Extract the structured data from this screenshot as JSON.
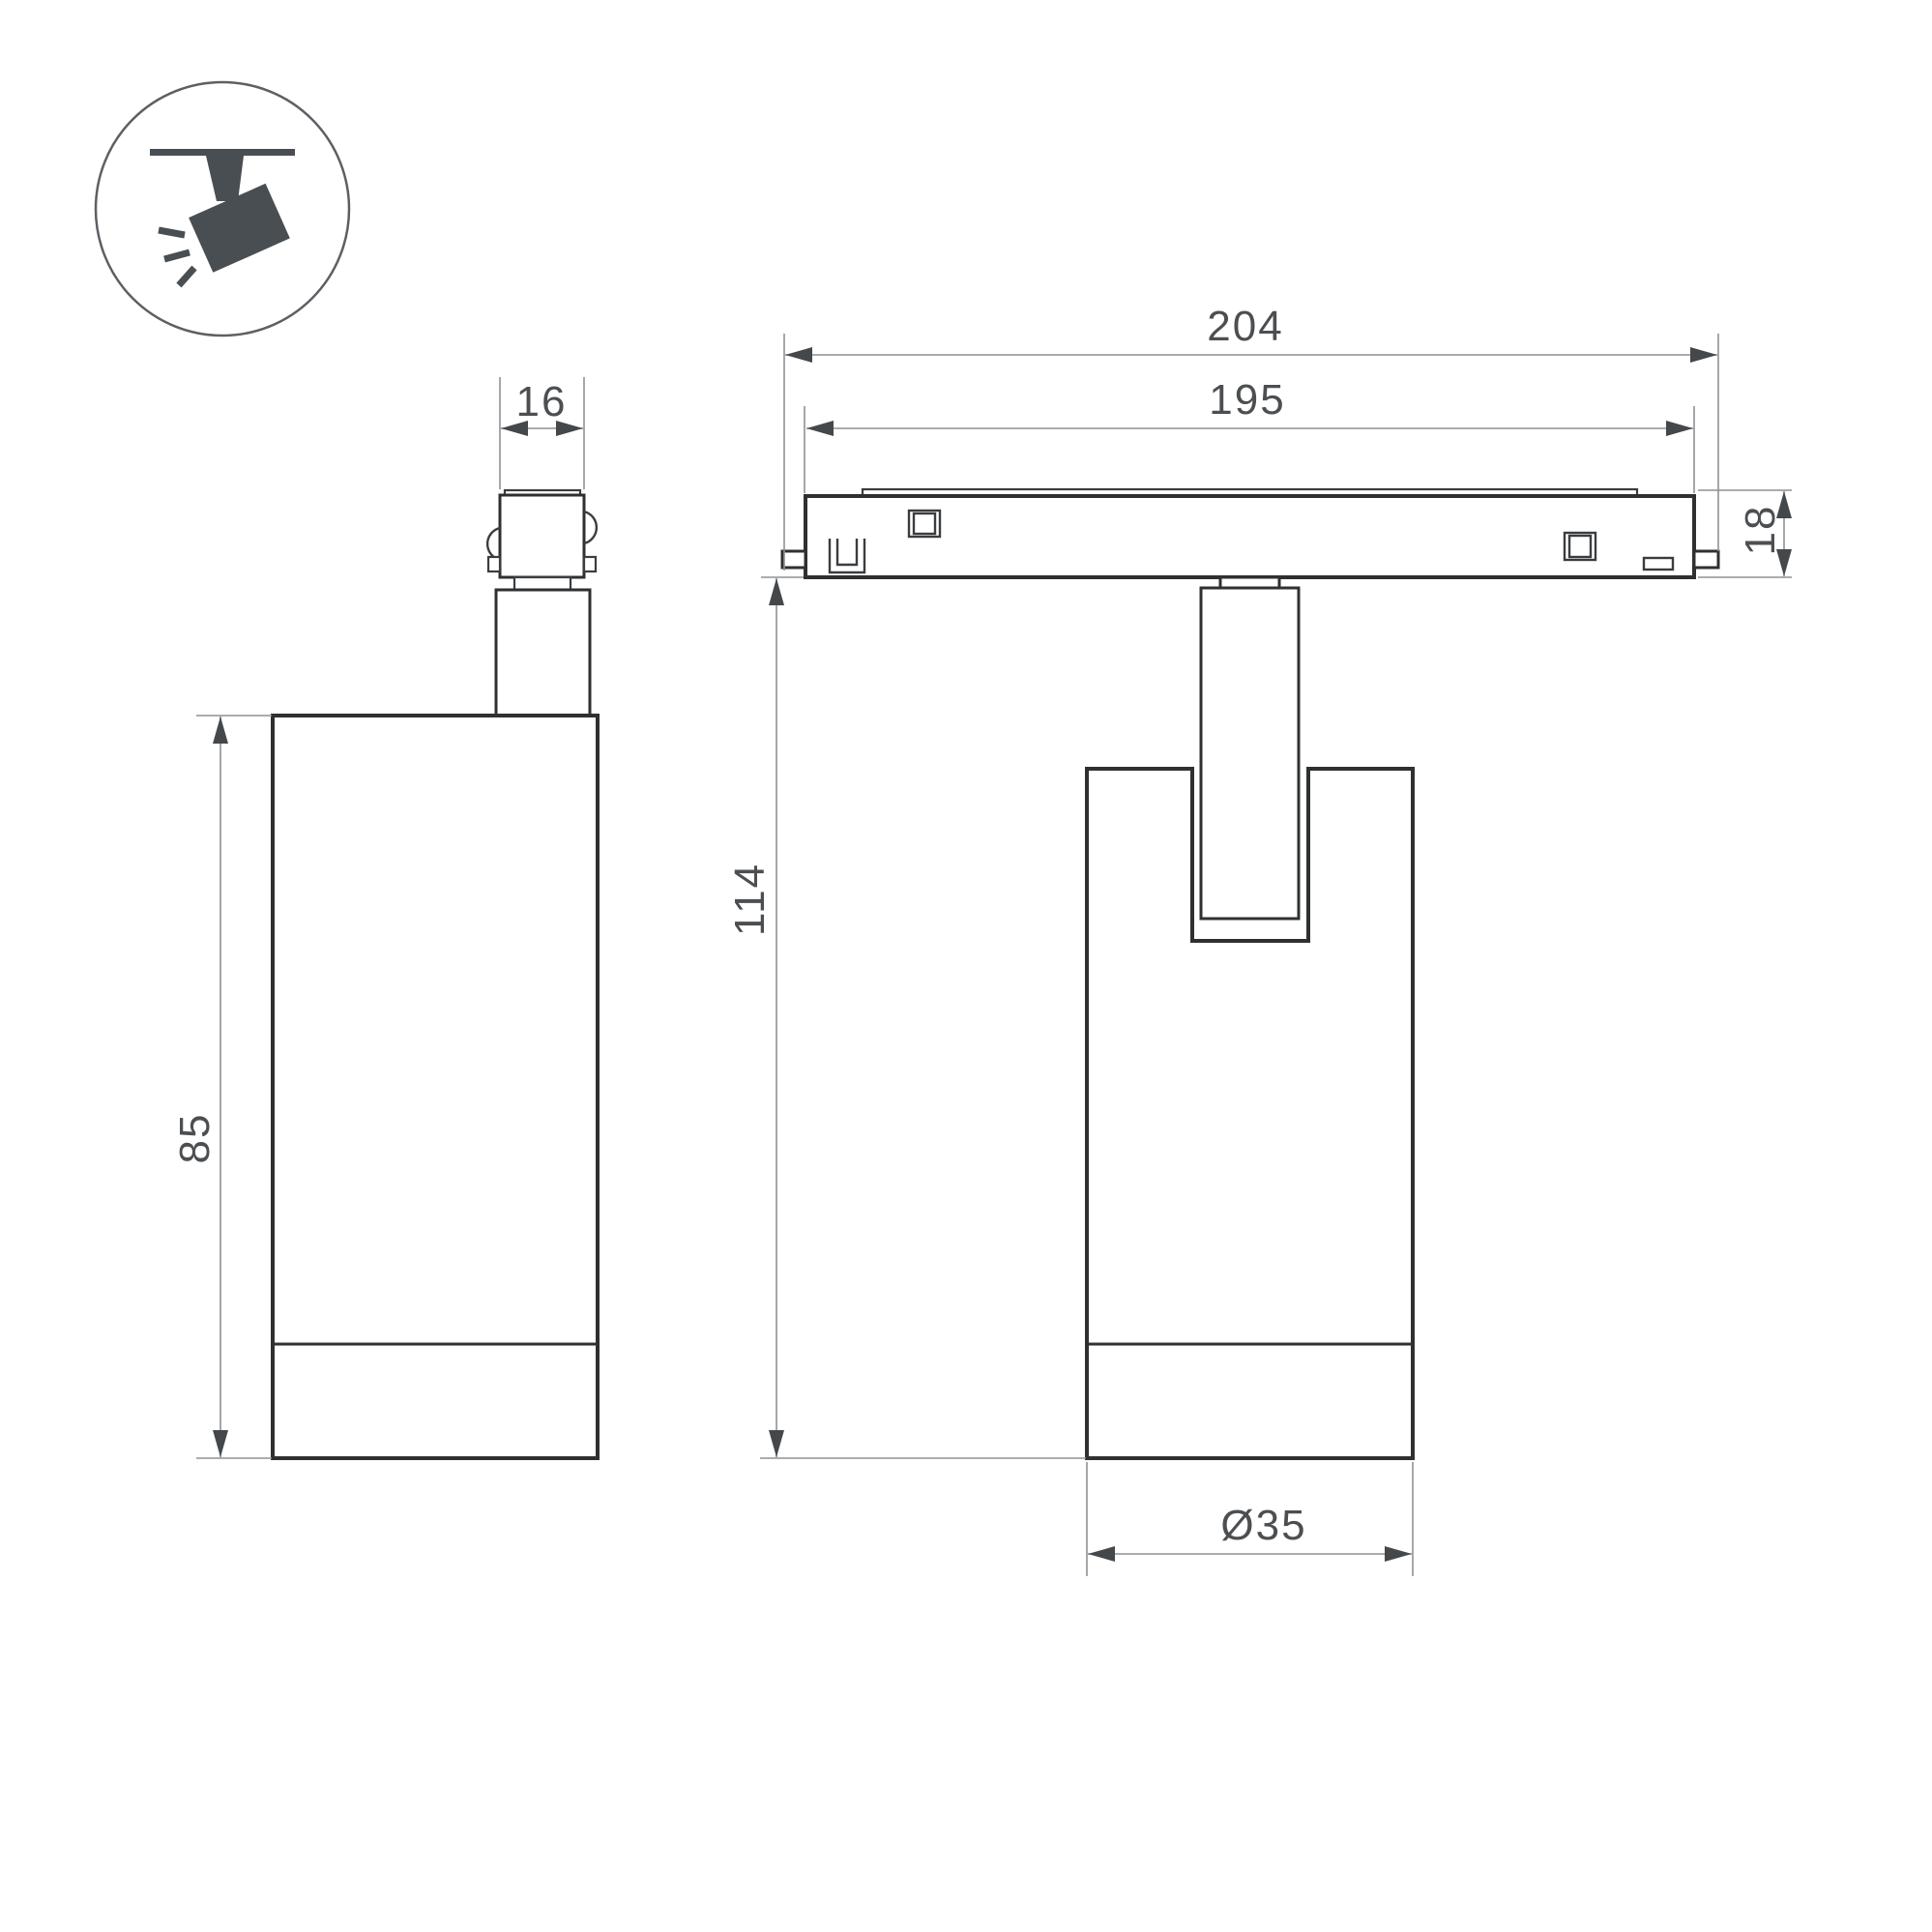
{
  "drawing": {
    "kind": "technical dimension drawing",
    "subject": "magnetic track spotlight, side and front views with ceiling-track pictogram"
  },
  "dimensions": {
    "adapter_width": "16",
    "body_height": "85",
    "track_length_overall": "204",
    "track_length_inner": "195",
    "track_height": "18",
    "fixture_height": "114",
    "body_diameter": "Ø35"
  },
  "colors": {
    "background": "#ffffff",
    "outline": "#2e3032",
    "detail": "#3a3d40",
    "dimension_line": "#8f9194",
    "arrow": "#45484b",
    "label": "#4c4f52",
    "icon": "#494e53",
    "icon_circle": "#5c6064"
  }
}
